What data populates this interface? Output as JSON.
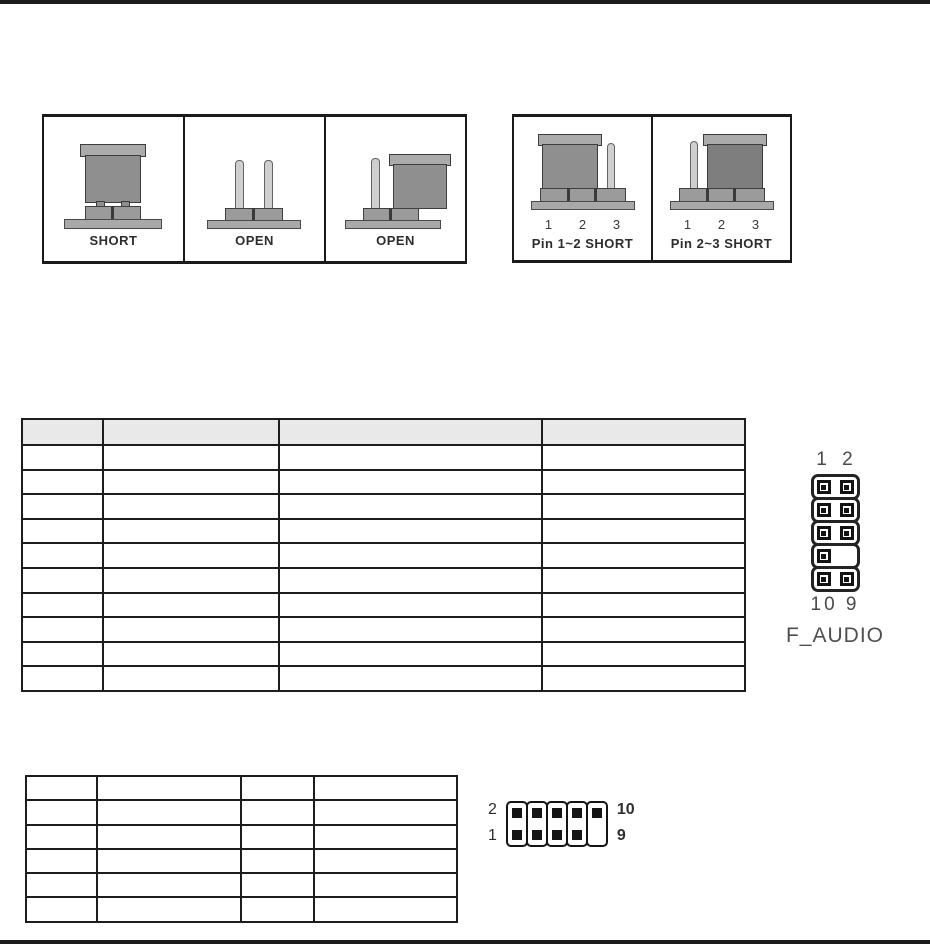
{
  "colors": {
    "rule": "#1b1b1e",
    "table_header_bg": "#e9e9e9",
    "jumper_cap_body": "#8f8f8f",
    "jumper_cap_body_dark": "#7e7e7e",
    "jumper_plate": "#a9a9a9",
    "bare_pin": "#cfcfcf"
  },
  "jumper_legend_two_pin": {
    "panels": [
      {
        "label": "SHORT"
      },
      {
        "label": "OPEN"
      },
      {
        "label": "OPEN"
      }
    ]
  },
  "jumper_legend_three_pin": {
    "panels": [
      {
        "label": "Pin 1~2 SHORT",
        "pins": [
          "1",
          "2",
          "3"
        ]
      },
      {
        "label": "Pin 2~3 SHORT",
        "pins": [
          "1",
          "2",
          "3"
        ]
      }
    ]
  },
  "front_audio_table": {
    "headers": [
      "",
      "",
      "",
      ""
    ],
    "rows": [
      [
        "",
        "",
        "",
        ""
      ],
      [
        "",
        "",
        "",
        ""
      ],
      [
        "",
        "",
        "",
        ""
      ],
      [
        "",
        "",
        "",
        ""
      ],
      [
        "",
        "",
        "",
        ""
      ],
      [
        "",
        "",
        "",
        ""
      ],
      [
        "",
        "",
        "",
        ""
      ],
      [
        "",
        "",
        "",
        ""
      ],
      [
        "",
        "",
        "",
        ""
      ],
      [
        "",
        "",
        "",
        ""
      ]
    ]
  },
  "audio_connector_diagram": {
    "top_label": "1 2",
    "bottom_label": "10 9",
    "name": "F_AUDIO"
  },
  "second_table": {
    "rows": [
      [
        "",
        "",
        "",
        ""
      ],
      [
        "",
        "",
        "",
        ""
      ],
      [
        "",
        "",
        "",
        ""
      ],
      [
        "",
        "",
        "",
        ""
      ],
      [
        "",
        "",
        "",
        ""
      ],
      [
        "",
        "",
        "",
        ""
      ]
    ]
  },
  "horizontal_connector_diagram": {
    "top_left_label": "2",
    "bottom_left_label": "1",
    "top_right_label": "10",
    "bottom_right_label": "9"
  }
}
